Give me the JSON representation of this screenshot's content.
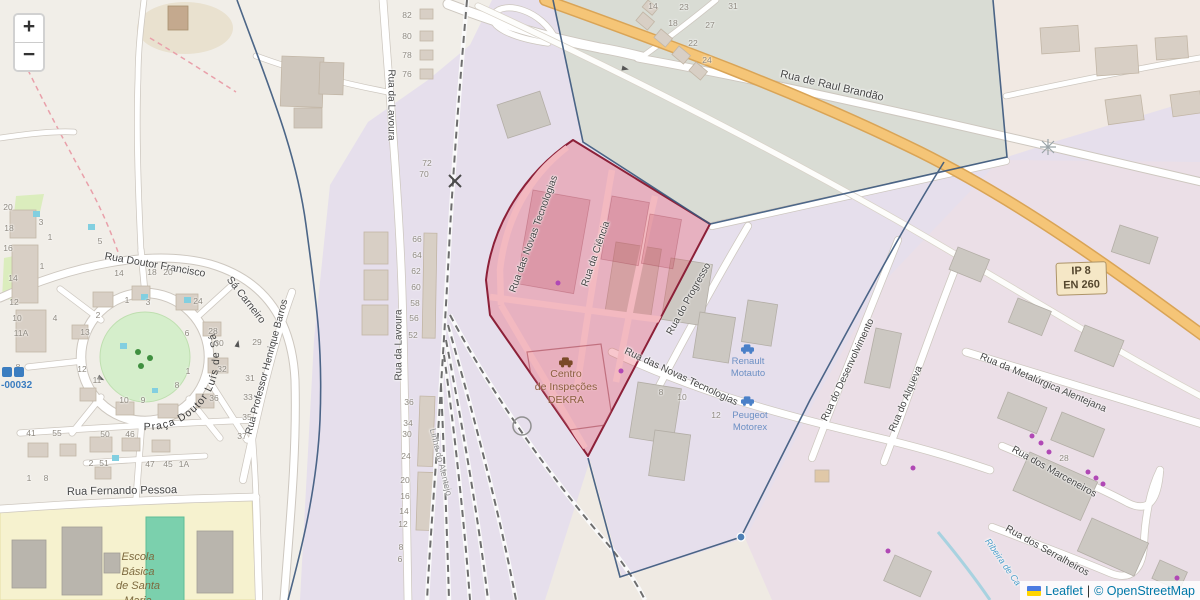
{
  "map": {
    "controls": {
      "zoom_in": "+",
      "zoom_out": "−"
    },
    "attribution": {
      "flag": "ukraine-flag",
      "leaflet": "Leaflet",
      "sep": "|",
      "copyright": "© OpenStreetMap"
    },
    "shield": {
      "l1": "IP 8",
      "l2": "EN 260"
    },
    "praca_label": "Praça Doutor Luís de Sá",
    "pois": {
      "dekra": {
        "l1": "Centro",
        "l2": "de Inspeções",
        "l3": "DEKRA"
      },
      "school": {
        "l1": "Escola",
        "l2": "Básica",
        "l3": "de Santa",
        "l4": "Maria"
      },
      "dealer1": {
        "l1": "Renault",
        "l2": "Motauto"
      },
      "dealer2": {
        "l1": "Peugeot",
        "l2": "Motorex"
      },
      "water_ref": "-00032"
    },
    "street_labels": [
      {
        "t": "Rua de Raul Brandão",
        "x": 832,
        "y": 86,
        "r": 13,
        "s": 11
      },
      {
        "t": "Rua da Lavoura",
        "x": 391,
        "y": 105,
        "r": 90,
        "s": 10
      },
      {
        "t": "Rua da Lavoura",
        "x": 399,
        "y": 345,
        "r": -90,
        "s": 10
      },
      {
        "t": "Linha do Alentejo",
        "x": 441,
        "y": 462,
        "r": 76,
        "s": 9,
        "c": "#8f8f8f"
      },
      {
        "t": "Rua Doutor Francisco",
        "x": 155,
        "y": 265,
        "r": 10,
        "s": 10.5
      },
      {
        "t": "Sá Carneiro",
        "x": 246,
        "y": 300,
        "r": 52,
        "s": 10.5
      },
      {
        "t": "Rua Professor Henrique Barros",
        "x": 267,
        "y": 367,
        "r": -75,
        "s": 10
      },
      {
        "t": "Rua Fernando Pessoa",
        "x": 122,
        "y": 491,
        "r": -1,
        "s": 11
      },
      {
        "t": "Rua das Novas Tecnologias",
        "x": 534,
        "y": 234,
        "r": -70,
        "s": 10
      },
      {
        "t": "Rua da Ciência",
        "x": 596,
        "y": 254,
        "r": -71,
        "s": 10
      },
      {
        "t": "Rua das Novas Tecnologias",
        "x": 681,
        "y": 377,
        "r": 25,
        "s": 10
      },
      {
        "t": "Rua do Progresso",
        "x": 689,
        "y": 299,
        "r": -61,
        "s": 10
      },
      {
        "t": "Rua do Desenvolvimento",
        "x": 848,
        "y": 370,
        "r": -65,
        "s": 10
      },
      {
        "t": "Rua do Alqueva",
        "x": 906,
        "y": 399,
        "r": -67,
        "s": 10
      },
      {
        "t": "Rua da Metalúrgica Alentejana",
        "x": 1043,
        "y": 383,
        "r": 23,
        "s": 10
      },
      {
        "t": "Rua dos Marceneiros",
        "x": 1054,
        "y": 472,
        "r": 29,
        "s": 10
      },
      {
        "t": "Rua dos Serralheiros",
        "x": 1047,
        "y": 551,
        "r": 29,
        "s": 10
      },
      {
        "t": "Ribeira de Ca",
        "x": 1003,
        "y": 562,
        "r": 55,
        "s": 9,
        "c": "#4d9fca",
        "i": true
      }
    ],
    "house_numbers": [
      {
        "t": "82",
        "x": 407,
        "y": 15
      },
      {
        "t": "80",
        "x": 407,
        "y": 36
      },
      {
        "t": "78",
        "x": 407,
        "y": 55
      },
      {
        "t": "76",
        "x": 407,
        "y": 74
      },
      {
        "t": "72",
        "x": 427,
        "y": 163
      },
      {
        "t": "70",
        "x": 424,
        "y": 174
      },
      {
        "t": "66",
        "x": 417,
        "y": 239
      },
      {
        "t": "64",
        "x": 417,
        "y": 255
      },
      {
        "t": "62",
        "x": 416,
        "y": 271
      },
      {
        "t": "60",
        "x": 416,
        "y": 287
      },
      {
        "t": "58",
        "x": 415,
        "y": 303
      },
      {
        "t": "56",
        "x": 414,
        "y": 318
      },
      {
        "t": "52",
        "x": 413,
        "y": 335
      },
      {
        "t": "36",
        "x": 409,
        "y": 402
      },
      {
        "t": "34",
        "x": 408,
        "y": 423
      },
      {
        "t": "30",
        "x": 407,
        "y": 434
      },
      {
        "t": "24",
        "x": 406,
        "y": 456
      },
      {
        "t": "20",
        "x": 405,
        "y": 480
      },
      {
        "t": "16",
        "x": 405,
        "y": 496
      },
      {
        "t": "14",
        "x": 404,
        "y": 511
      },
      {
        "t": "12",
        "x": 403,
        "y": 524
      },
      {
        "t": "8",
        "x": 401,
        "y": 547
      },
      {
        "t": "6",
        "x": 400,
        "y": 559
      },
      {
        "t": "20",
        "x": 8,
        "y": 207
      },
      {
        "t": "18",
        "x": 9,
        "y": 228
      },
      {
        "t": "16",
        "x": 8,
        "y": 248
      },
      {
        "t": "14",
        "x": 13,
        "y": 278
      },
      {
        "t": "12",
        "x": 14,
        "y": 302
      },
      {
        "t": "10",
        "x": 17,
        "y": 318
      },
      {
        "t": "11A",
        "x": 21,
        "y": 333
      },
      {
        "t": "3",
        "x": 41,
        "y": 222
      },
      {
        "t": "1",
        "x": 50,
        "y": 237
      },
      {
        "t": "1",
        "x": 42,
        "y": 266
      },
      {
        "t": "4",
        "x": 55,
        "y": 318
      },
      {
        "t": "8",
        "x": 18,
        "y": 367
      },
      {
        "t": "5",
        "x": 100,
        "y": 241
      },
      {
        "t": "14",
        "x": 119,
        "y": 273
      },
      {
        "t": "18",
        "x": 152,
        "y": 272
      },
      {
        "t": "20",
        "x": 168,
        "y": 272
      },
      {
        "t": "1",
        "x": 127,
        "y": 300
      },
      {
        "t": "3",
        "x": 148,
        "y": 302
      },
      {
        "t": "24",
        "x": 198,
        "y": 301
      },
      {
        "t": "2",
        "x": 98,
        "y": 315
      },
      {
        "t": "13",
        "x": 85,
        "y": 332
      },
      {
        "t": "6",
        "x": 187,
        "y": 333
      },
      {
        "t": "28",
        "x": 213,
        "y": 331
      },
      {
        "t": "30",
        "x": 219,
        "y": 343
      },
      {
        "t": "12",
        "x": 82,
        "y": 369
      },
      {
        "t": "11",
        "x": 97,
        "y": 380
      },
      {
        "t": "1",
        "x": 188,
        "y": 371
      },
      {
        "t": "8",
        "x": 177,
        "y": 385
      },
      {
        "t": "32",
        "x": 222,
        "y": 369
      },
      {
        "t": "36",
        "x": 214,
        "y": 398
      },
      {
        "t": "10",
        "x": 124,
        "y": 400
      },
      {
        "t": "9",
        "x": 143,
        "y": 400
      },
      {
        "t": "29",
        "x": 257,
        "y": 342
      },
      {
        "t": "31",
        "x": 250,
        "y": 378
      },
      {
        "t": "33",
        "x": 248,
        "y": 397
      },
      {
        "t": "35",
        "x": 247,
        "y": 417
      },
      {
        "t": "37",
        "x": 242,
        "y": 436
      },
      {
        "t": "41",
        "x": 31,
        "y": 433
      },
      {
        "t": "55",
        "x": 57,
        "y": 433
      },
      {
        "t": "50",
        "x": 105,
        "y": 434
      },
      {
        "t": "46",
        "x": 130,
        "y": 434
      },
      {
        "t": "2",
        "x": 91,
        "y": 463
      },
      {
        "t": "51",
        "x": 104,
        "y": 463
      },
      {
        "t": "47",
        "x": 150,
        "y": 464
      },
      {
        "t": "45",
        "x": 168,
        "y": 464
      },
      {
        "t": "1A",
        "x": 184,
        "y": 464
      },
      {
        "t": "1",
        "x": 29,
        "y": 478
      },
      {
        "t": "8",
        "x": 46,
        "y": 478
      },
      {
        "t": "14",
        "x": 653,
        "y": 6
      },
      {
        "t": "23",
        "x": 684,
        "y": 7
      },
      {
        "t": "31",
        "x": 733,
        "y": 6
      },
      {
        "t": "18",
        "x": 673,
        "y": 23
      },
      {
        "t": "27",
        "x": 710,
        "y": 25
      },
      {
        "t": "22",
        "x": 693,
        "y": 43
      },
      {
        "t": "24",
        "x": 707,
        "y": 60
      },
      {
        "t": "8",
        "x": 661,
        "y": 392
      },
      {
        "t": "10",
        "x": 682,
        "y": 397
      },
      {
        "t": "12",
        "x": 716,
        "y": 415
      },
      {
        "t": "28",
        "x": 1064,
        "y": 458
      }
    ]
  }
}
